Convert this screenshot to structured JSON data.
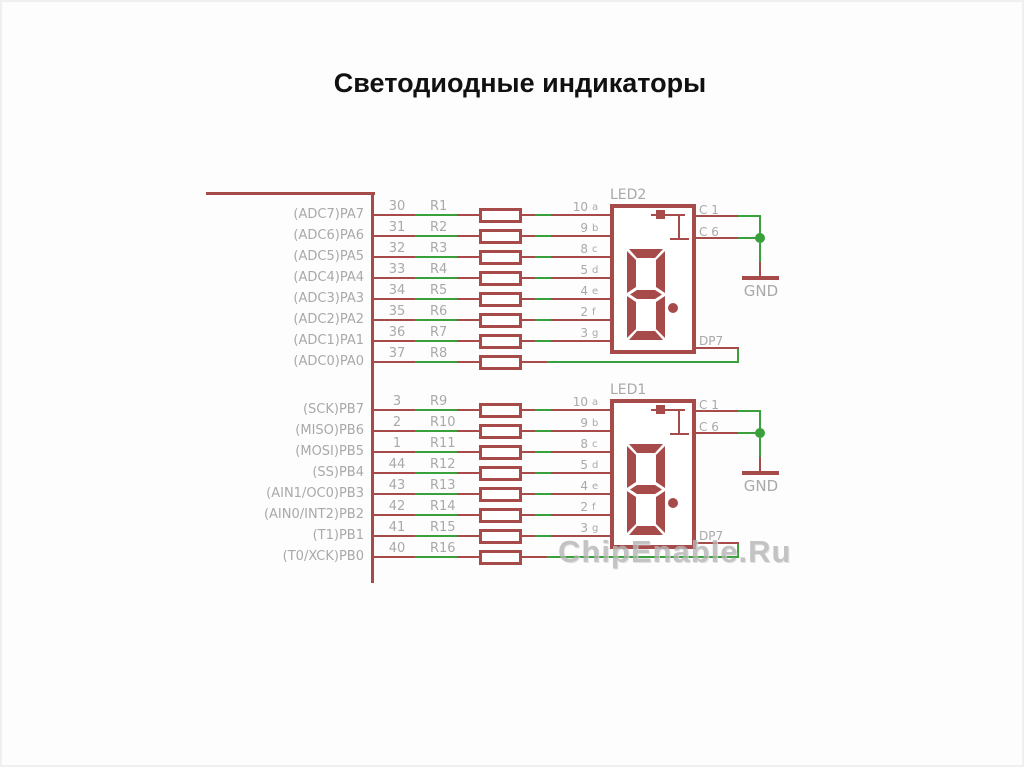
{
  "title": "Светодиодные индикаторы",
  "watermark": "ChipEnable.Ru",
  "colors": {
    "wire_red": "#a64a4a",
    "net_green": "#3aa03c",
    "label_gray": "#a9a9a9",
    "title_black": "#111111",
    "background": "#fdfdfd"
  },
  "schematic": {
    "mcu_sections": [
      {
        "rows": [
          {
            "port": "(ADC7)PA7",
            "pin": "30",
            "resistor": "R1",
            "seg_pad": "10",
            "seg": "a"
          },
          {
            "port": "(ADC6)PA6",
            "pin": "31",
            "resistor": "R2",
            "seg_pad": "9",
            "seg": "b"
          },
          {
            "port": "(ADC5)PA5",
            "pin": "32",
            "resistor": "R3",
            "seg_pad": "8",
            "seg": "c"
          },
          {
            "port": "(ADC4)PA4",
            "pin": "33",
            "resistor": "R4",
            "seg_pad": "5",
            "seg": "d"
          },
          {
            "port": "(ADC3)PA3",
            "pin": "34",
            "resistor": "R5",
            "seg_pad": "4",
            "seg": "e"
          },
          {
            "port": "(ADC2)PA2",
            "pin": "35",
            "resistor": "R6",
            "seg_pad": "2",
            "seg": "f"
          },
          {
            "port": "(ADC1)PA1",
            "pin": "36",
            "resistor": "R7",
            "seg_pad": "3",
            "seg": "g"
          },
          {
            "port": "(ADC0)PA0",
            "pin": "37",
            "resistor": "R8",
            "seg_pad": "",
            "seg": ""
          }
        ]
      },
      {
        "rows": [
          {
            "port": "(SCK)PB7",
            "pin": "3",
            "resistor": "R9",
            "seg_pad": "10",
            "seg": "a"
          },
          {
            "port": "(MISO)PB6",
            "pin": "2",
            "resistor": "R10",
            "seg_pad": "9",
            "seg": "b"
          },
          {
            "port": "(MOSI)PB5",
            "pin": "1",
            "resistor": "R11",
            "seg_pad": "8",
            "seg": "c"
          },
          {
            "port": "(SS)PB4",
            "pin": "44",
            "resistor": "R12",
            "seg_pad": "5",
            "seg": "d"
          },
          {
            "port": "(AIN1/OC0)PB3",
            "pin": "43",
            "resistor": "R13",
            "seg_pad": "4",
            "seg": "e"
          },
          {
            "port": "(AIN0/INT2)PB2",
            "pin": "42",
            "resistor": "R14",
            "seg_pad": "2",
            "seg": "f"
          },
          {
            "port": "(T1)PB1",
            "pin": "41",
            "resistor": "R15",
            "seg_pad": "3",
            "seg": "g"
          },
          {
            "port": "(T0/XCK)PB0",
            "pin": "40",
            "resistor": "R16",
            "seg_pad": "",
            "seg": ""
          }
        ]
      }
    ],
    "displays": [
      {
        "name": "LED2",
        "digit": "8",
        "decimal_point": true,
        "pin_c1": "C 1",
        "pin_c6": "C 6",
        "pin_dp": "DP7",
        "gnd_label": "GND"
      },
      {
        "name": "LED1",
        "digit": "8",
        "decimal_point": true,
        "pin_c1": "C 1",
        "pin_c6": "C 6",
        "pin_dp": "DP7",
        "gnd_label": "GND"
      }
    ]
  }
}
